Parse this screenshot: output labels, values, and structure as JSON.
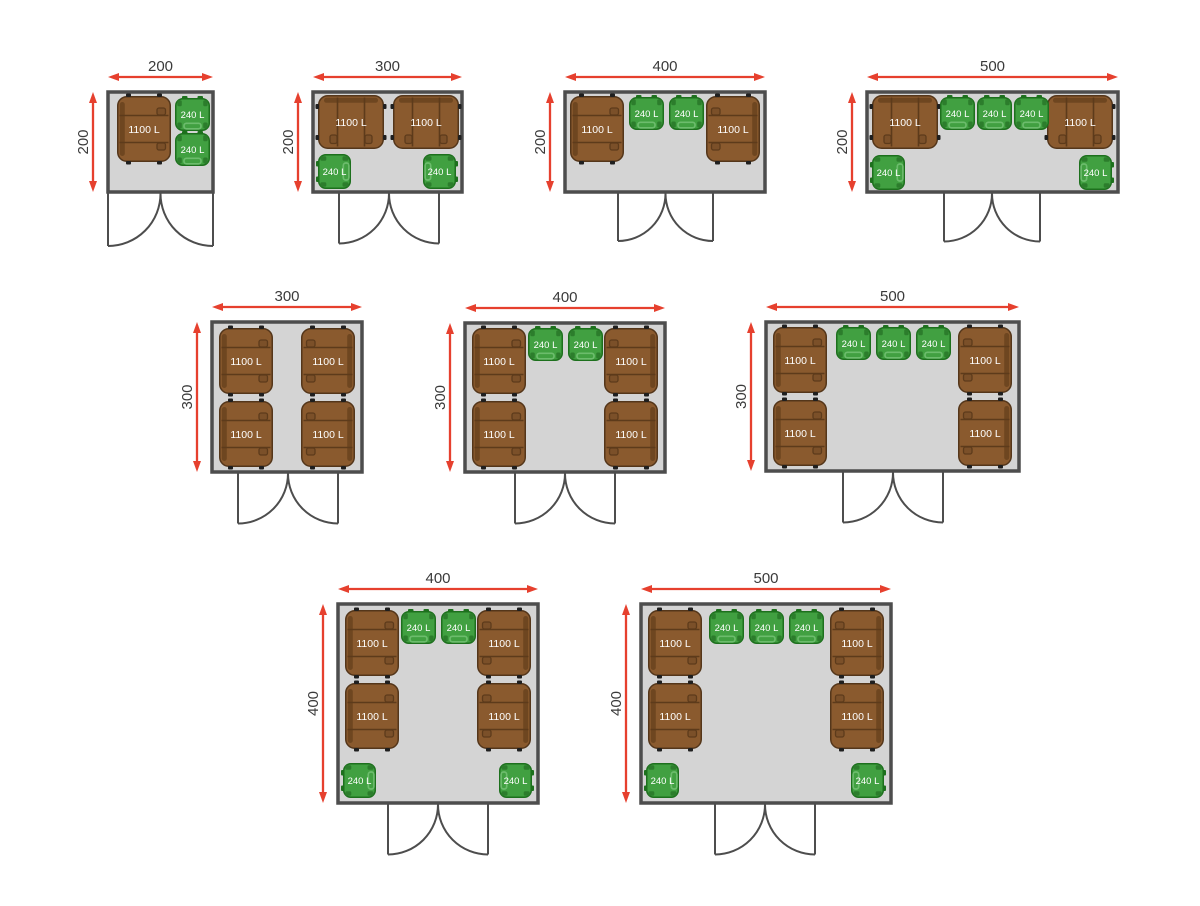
{
  "diagram": {
    "description": "Bin shelter floor plan layouts",
    "unit_scale_px_per_unit": 0.5
  },
  "labels": {
    "container_1100": "1100 L",
    "bin_240": "240 L"
  },
  "colors": {
    "background": "#ffffff",
    "arrow": "#e6402e",
    "dim_text": "#3a3a3a",
    "wall": "#4d4d4d",
    "room_fill": "#d4d4d4",
    "door": "#4d4d4d",
    "container_body": "#8a5a2e",
    "container_outline": "#54361a",
    "container_line": "#5d3b1b",
    "container_back": "#6e4620",
    "wheel": "#1f1f1f",
    "bin_body": "#41a041",
    "bin_outline": "#1d701d",
    "bin_inset": "#2c7d2c",
    "bin_handle": "#6cbc6c",
    "item_text": "#ffffff"
  },
  "layouts": [
    {
      "id": "200x200",
      "width_label": "200",
      "height_label": "200",
      "room": {
        "x": 108,
        "y": 92,
        "w": 105,
        "h": 100
      },
      "door": {
        "x": 108,
        "w": 105
      },
      "items": [
        {
          "kind": "1100L",
          "facing": "right",
          "x": 9,
          "y": 4
        },
        {
          "kind": "240L",
          "facing": "down",
          "x": 67,
          "y": 6
        },
        {
          "kind": "240L",
          "facing": "down",
          "x": 67,
          "y": 41
        }
      ]
    },
    {
      "id": "300x200",
      "width_label": "300",
      "height_label": "200",
      "room": {
        "x": 313,
        "y": 92,
        "w": 149,
        "h": 100
      },
      "door": {
        "x": 339,
        "w": 100
      },
      "items": [
        {
          "kind": "1100L",
          "facing": "down",
          "x": 5,
          "y": 3
        },
        {
          "kind": "1100L",
          "facing": "down",
          "x": 80,
          "y": 3
        },
        {
          "kind": "240L",
          "facing": "right",
          "x": 5,
          "y": 62
        },
        {
          "kind": "240L",
          "facing": "left",
          "x": 110,
          "y": 62
        }
      ]
    },
    {
      "id": "400x200",
      "width_label": "400",
      "height_label": "200",
      "room": {
        "x": 565,
        "y": 92,
        "w": 200,
        "h": 100
      },
      "door": {
        "x": 618,
        "w": 95
      },
      "items": [
        {
          "kind": "1100L",
          "facing": "right",
          "x": 5,
          "y": 4
        },
        {
          "kind": "1100L",
          "facing": "left",
          "x": 141,
          "y": 4
        },
        {
          "kind": "240L",
          "facing": "down",
          "x": 64,
          "y": 5
        },
        {
          "kind": "240L",
          "facing": "down",
          "x": 104,
          "y": 5
        }
      ]
    },
    {
      "id": "500x200",
      "width_label": "500",
      "height_label": "200",
      "room": {
        "x": 867,
        "y": 92,
        "w": 251,
        "h": 100
      },
      "door": {
        "x": 944,
        "w": 96
      },
      "items": [
        {
          "kind": "1100L",
          "facing": "down",
          "x": 5,
          "y": 3
        },
        {
          "kind": "1100L",
          "facing": "down",
          "x": 180,
          "y": 3
        },
        {
          "kind": "240L",
          "facing": "down",
          "x": 73,
          "y": 5
        },
        {
          "kind": "240L",
          "facing": "down",
          "x": 110,
          "y": 5
        },
        {
          "kind": "240L",
          "facing": "down",
          "x": 147,
          "y": 5
        },
        {
          "kind": "240L",
          "facing": "right",
          "x": 5,
          "y": 63
        },
        {
          "kind": "240L",
          "facing": "left",
          "x": 212,
          "y": 63
        }
      ]
    },
    {
      "id": "300x300",
      "width_label": "300",
      "height_label": "300",
      "room": {
        "x": 212,
        "y": 322,
        "w": 150,
        "h": 150
      },
      "door": {
        "x": 238,
        "w": 100
      },
      "items": [
        {
          "kind": "1100L",
          "facing": "right",
          "x": 7,
          "y": 6
        },
        {
          "kind": "1100L",
          "facing": "right",
          "x": 7,
          "y": 79
        },
        {
          "kind": "1100L",
          "facing": "left",
          "x": 89,
          "y": 6
        },
        {
          "kind": "1100L",
          "facing": "left",
          "x": 89,
          "y": 79
        }
      ]
    },
    {
      "id": "400x300",
      "width_label": "400",
      "height_label": "300",
      "room": {
        "x": 465,
        "y": 323,
        "w": 200,
        "h": 149
      },
      "door": {
        "x": 515,
        "w": 100
      },
      "items": [
        {
          "kind": "1100L",
          "facing": "right",
          "x": 7,
          "y": 5
        },
        {
          "kind": "1100L",
          "facing": "right",
          "x": 7,
          "y": 78
        },
        {
          "kind": "1100L",
          "facing": "left",
          "x": 139,
          "y": 5
        },
        {
          "kind": "1100L",
          "facing": "left",
          "x": 139,
          "y": 78
        },
        {
          "kind": "240L",
          "facing": "down",
          "x": 63,
          "y": 5
        },
        {
          "kind": "240L",
          "facing": "down",
          "x": 103,
          "y": 5
        }
      ]
    },
    {
      "id": "500x300",
      "width_label": "500",
      "height_label": "300",
      "room": {
        "x": 766,
        "y": 322,
        "w": 253,
        "h": 149
      },
      "door": {
        "x": 843,
        "w": 100
      },
      "items": [
        {
          "kind": "1100L",
          "facing": "right",
          "x": 7,
          "y": 5
        },
        {
          "kind": "1100L",
          "facing": "right",
          "x": 7,
          "y": 78
        },
        {
          "kind": "1100L",
          "facing": "left",
          "x": 192,
          "y": 5
        },
        {
          "kind": "1100L",
          "facing": "left",
          "x": 192,
          "y": 78
        },
        {
          "kind": "240L",
          "facing": "down",
          "x": 70,
          "y": 5
        },
        {
          "kind": "240L",
          "facing": "down",
          "x": 110,
          "y": 5
        },
        {
          "kind": "240L",
          "facing": "down",
          "x": 150,
          "y": 5
        }
      ]
    },
    {
      "id": "400x400",
      "width_label": "400",
      "height_label": "400",
      "room": {
        "x": 338,
        "y": 604,
        "w": 200,
        "h": 199
      },
      "door": {
        "x": 388,
        "w": 100
      },
      "items": [
        {
          "kind": "1100L",
          "facing": "right",
          "x": 7,
          "y": 6
        },
        {
          "kind": "1100L",
          "facing": "right",
          "x": 7,
          "y": 79
        },
        {
          "kind": "1100L",
          "facing": "left",
          "x": 139,
          "y": 6
        },
        {
          "kind": "1100L",
          "facing": "left",
          "x": 139,
          "y": 79
        },
        {
          "kind": "240L",
          "facing": "down",
          "x": 63,
          "y": 7
        },
        {
          "kind": "240L",
          "facing": "down",
          "x": 103,
          "y": 7
        },
        {
          "kind": "240L",
          "facing": "right",
          "x": 5,
          "y": 159
        },
        {
          "kind": "240L",
          "facing": "left",
          "x": 161,
          "y": 159
        }
      ]
    },
    {
      "id": "500x400",
      "width_label": "500",
      "height_label": "400",
      "room": {
        "x": 641,
        "y": 604,
        "w": 250,
        "h": 199
      },
      "door": {
        "x": 715,
        "w": 100
      },
      "items": [
        {
          "kind": "1100L",
          "facing": "right",
          "x": 7,
          "y": 6
        },
        {
          "kind": "1100L",
          "facing": "right",
          "x": 7,
          "y": 79
        },
        {
          "kind": "1100L",
          "facing": "left",
          "x": 189,
          "y": 6
        },
        {
          "kind": "1100L",
          "facing": "left",
          "x": 189,
          "y": 79
        },
        {
          "kind": "240L",
          "facing": "down",
          "x": 68,
          "y": 7
        },
        {
          "kind": "240L",
          "facing": "down",
          "x": 108,
          "y": 7
        },
        {
          "kind": "240L",
          "facing": "down",
          "x": 148,
          "y": 7
        },
        {
          "kind": "240L",
          "facing": "right",
          "x": 5,
          "y": 159
        },
        {
          "kind": "240L",
          "facing": "left",
          "x": 210,
          "y": 159
        }
      ]
    }
  ]
}
